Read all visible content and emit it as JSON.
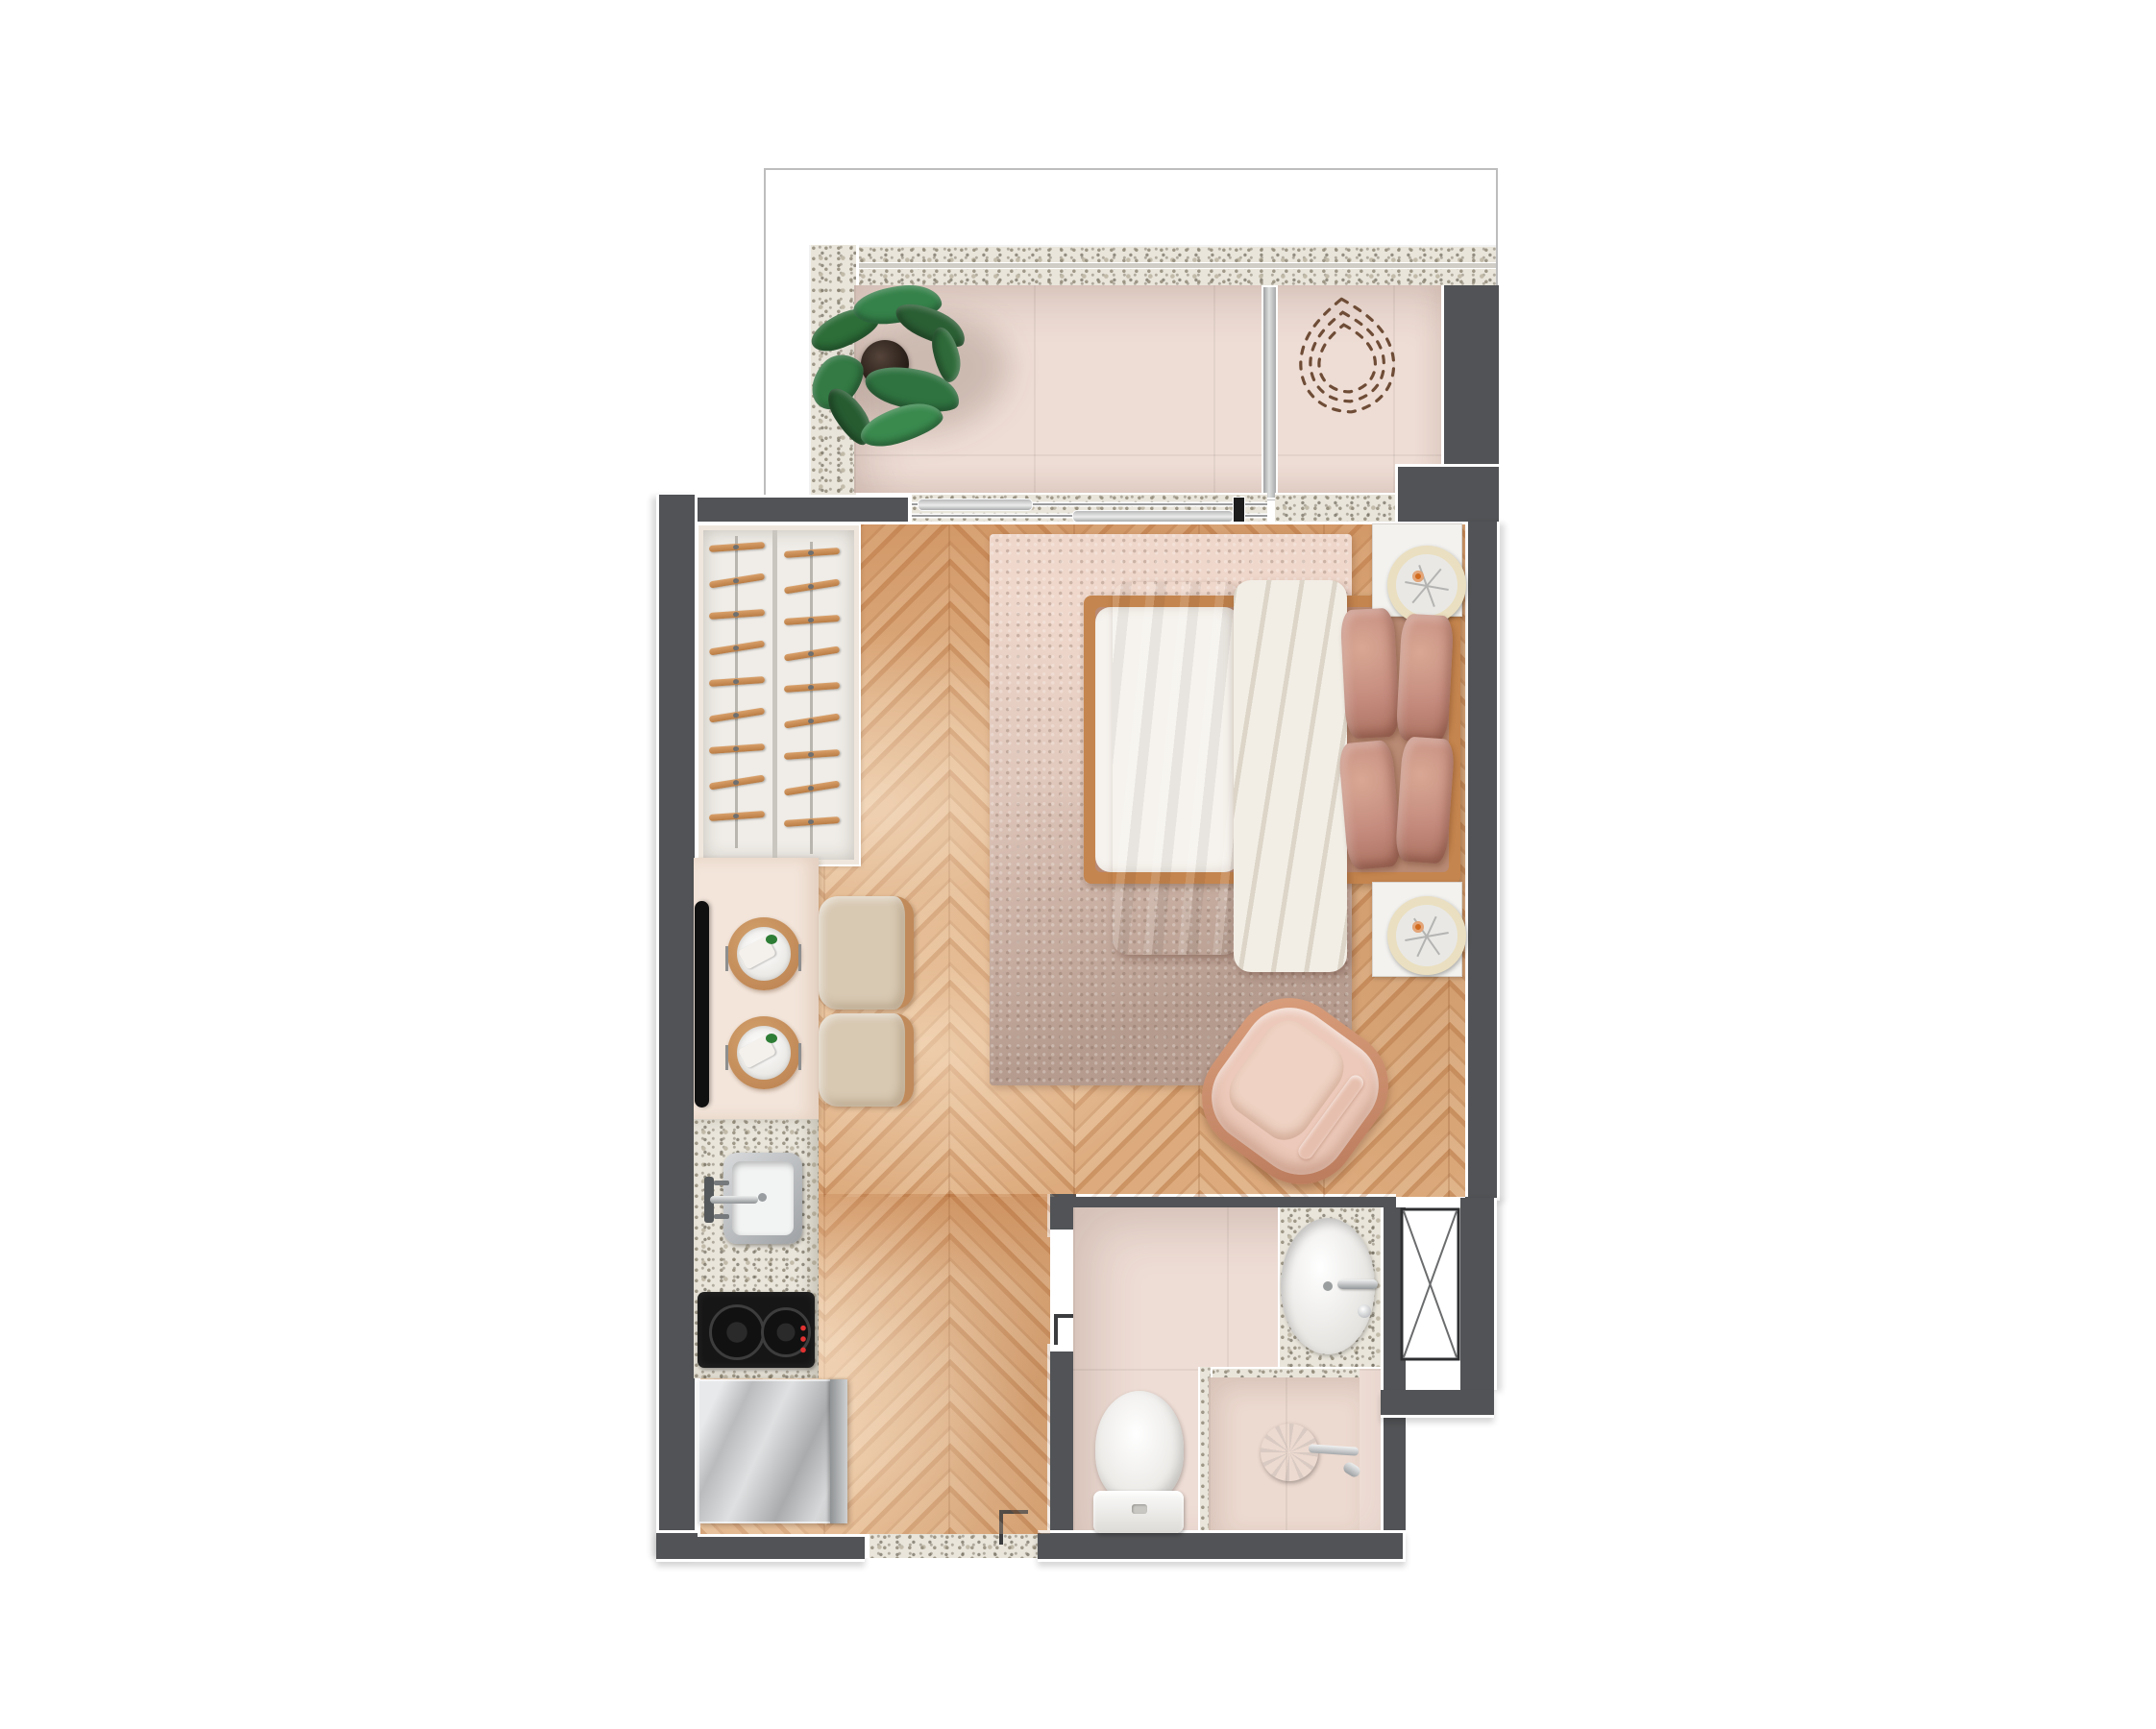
{
  "meta": {
    "type": "architectural-floor-plan",
    "view": "top-down-3d-render",
    "subject": "studio-apartment-unit",
    "description": "Top-down rendered floor plan of a studio apartment with balcony, wardrobe, kitchenette, double bed, armchair and bathroom"
  },
  "palette": {
    "background": "#ffffff",
    "wall_dark": "#515356",
    "wall_outline": "#ffffff",
    "granite_base": "#e9e5db",
    "balcony_tile": "#eeddd5",
    "wood_light": "#e3b084",
    "wood_dark": "#d3986a",
    "rug_pink": "#e9d2c6",
    "rug_taupe": "#b9a294",
    "bed_frame_wood": "#c5854e",
    "duvet_white": "#f2eee7",
    "blanket_mauve": "#ad7265",
    "pillow_mauve": "#c48b7d",
    "counter_cream": "#f3e5da",
    "chair_beige": "#d8c9b3",
    "chair_wood_trim": "#c08a5a",
    "steel": "#c7c9cb",
    "cooktop_black": "#161616",
    "indicator_red": "#e03131",
    "fan_ring_cream": "#eadfc0",
    "fan_hub_orange": "#d06a1e",
    "plant_green": "#2f7340",
    "plant_pot": "#322822",
    "dashed_outline_brown": "#6e4c36",
    "armchair_blush": "#ecc9ba",
    "armchair_copper": "#c98a68"
  },
  "balcony": {
    "items": [
      {
        "name": "potted-plant"
      },
      {
        "name": "hanging-chair-dashed-outline"
      },
      {
        "name": "glass-partition"
      },
      {
        "name": "sliding-glass-door",
        "panels": 2
      },
      {
        "name": "granite-parapet-wall"
      }
    ]
  },
  "main_room": {
    "wardrobe": {
      "columns": 2,
      "hangers_per_column": 9
    },
    "tv": {
      "mounted": "left-wall"
    },
    "dining": {
      "place_settings": 2,
      "chairs": 2
    },
    "bed": {
      "size": "double",
      "pillows": 4
    },
    "nightstands": {
      "count": 2,
      "decor_fans": 2
    },
    "rug": {
      "count": 1
    },
    "armchair": {
      "count": 1
    }
  },
  "kitchen": {
    "items": [
      {
        "name": "kitchen-sink"
      },
      {
        "name": "kitchen-faucet"
      },
      {
        "name": "cooktop",
        "burners": 2
      },
      {
        "name": "refrigerator"
      }
    ]
  },
  "bathroom": {
    "items": [
      {
        "name": "vanity-sink"
      },
      {
        "name": "vanity-faucet"
      },
      {
        "name": "toilet"
      },
      {
        "name": "shower"
      },
      {
        "name": "granite-curb"
      },
      {
        "name": "duct-shaft"
      }
    ]
  },
  "entry": {
    "items": [
      {
        "name": "entry-threshold"
      },
      {
        "name": "door-stop-bracket"
      }
    ]
  }
}
